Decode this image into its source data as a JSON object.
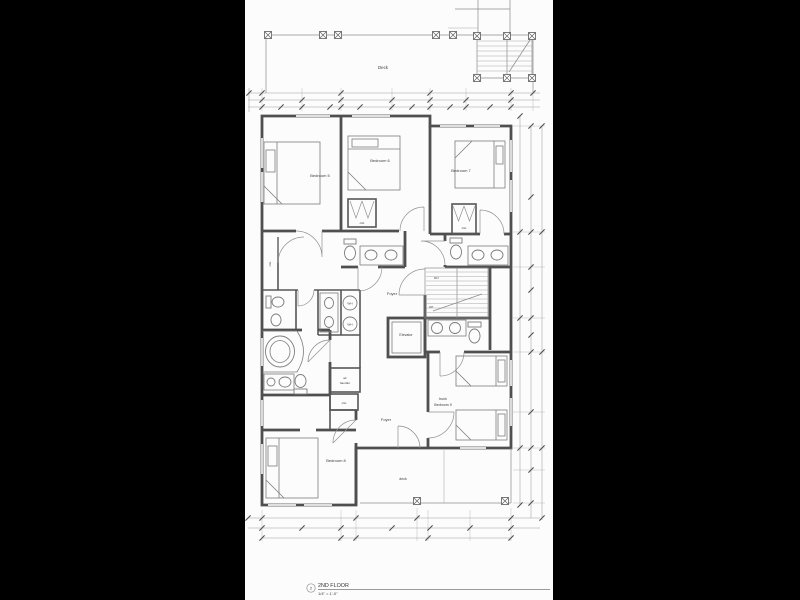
{
  "title_block": {
    "detail_number": "2",
    "title": "2ND FLOOR",
    "scale": "1/4\" = 1'-0\""
  },
  "labels": {
    "deck_top": "Deck",
    "deck_bottom": "deck",
    "bedroom5": "Bedroom 5",
    "bedroom6": "Bedroom 6",
    "bedroom7": "Bedroom 7",
    "bedroom8": "Bedroom 8",
    "bedroom9_line1": "bunk",
    "bedroom9_line2": "Bedroom 9",
    "foyer_upper": "Foyer",
    "foyer_lower": "Foyer",
    "elevator": "Elevator",
    "air_handler_line1": "air",
    "air_handler_line2": "handler",
    "closet_b5": "clst",
    "closet_b6": "clst",
    "closet_b7": "clst",
    "closet_mech": "clst",
    "stairs_down": "DN",
    "stairs_up": "UP",
    "water_heater_1": "WH",
    "water_heater_2": "WH"
  },
  "colors": {
    "background": "#000000",
    "sheet": "#fcfcfc",
    "wall": "#4f4f4f",
    "thin_line": "#8c8c8c",
    "text": "#3b3b3b"
  }
}
